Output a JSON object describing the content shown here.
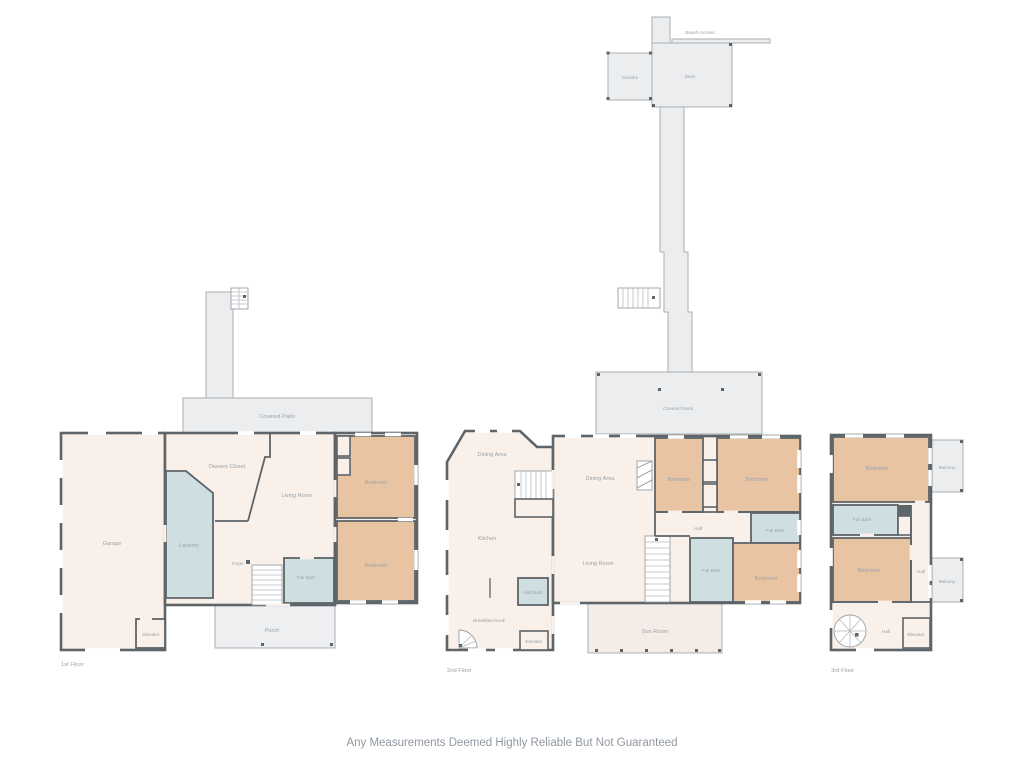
{
  "disclaimer": "Any Measurements Deemed Highly Reliable But Not Guaranteed",
  "colors": {
    "wall": "#5d646a",
    "interior": "#f8f0e9",
    "bedroom": "#e9c4a2",
    "bathroom": "#cfdfe1",
    "outdoor": "#ecedee",
    "label_text": "#9aa2ab",
    "disclaimer_text": "#8f97a1"
  },
  "floor1": {
    "name": "1st Floor",
    "rooms": {
      "covered_patio": "Covered Patio",
      "garage": "Garage",
      "owners_closet": "Owners Closet",
      "living_room": "Living Room",
      "laundry": "Laundry",
      "foyer": "Foyer",
      "full_bath": "Full Bath",
      "bedroom_top": "Bedroom",
      "bedroom_bottom": "Bedroom",
      "porch": "Porch",
      "elevator": "Elevator"
    }
  },
  "floor2": {
    "name": "2nd Floor",
    "rooms": {
      "beach_access": "Beach Access",
      "gazebo": "Gazebo",
      "deck": "Deck",
      "covered_deck": "Covered Deck",
      "dining_area_left": "Dining Area",
      "dining_area": "Dining Area",
      "kitchen": "Kitchen",
      "breakfast_nook": "Breakfast Nook",
      "half_bath": "Half Bath",
      "elevator": "Elevator",
      "living_room": "Living Room",
      "hall": "Hall",
      "bedroom_left": "Bedroom",
      "bedroom_right": "Bedroom",
      "bedroom_bottom": "Bedroom",
      "full_bath_upper": "Full Bath",
      "full_bath_lower": "Full Bath",
      "sun_room": "Sun Room"
    }
  },
  "floor3": {
    "name": "3rd Floor",
    "rooms": {
      "bedroom_top": "Bedroom",
      "balcony_top": "Balcony",
      "full_bath": "Full Bath",
      "bedroom_bottom": "Bedroom",
      "hall_right": "Hall",
      "hall_bottom": "Hall",
      "balcony_bottom": "Balcony",
      "elevator": "Elevator"
    }
  }
}
